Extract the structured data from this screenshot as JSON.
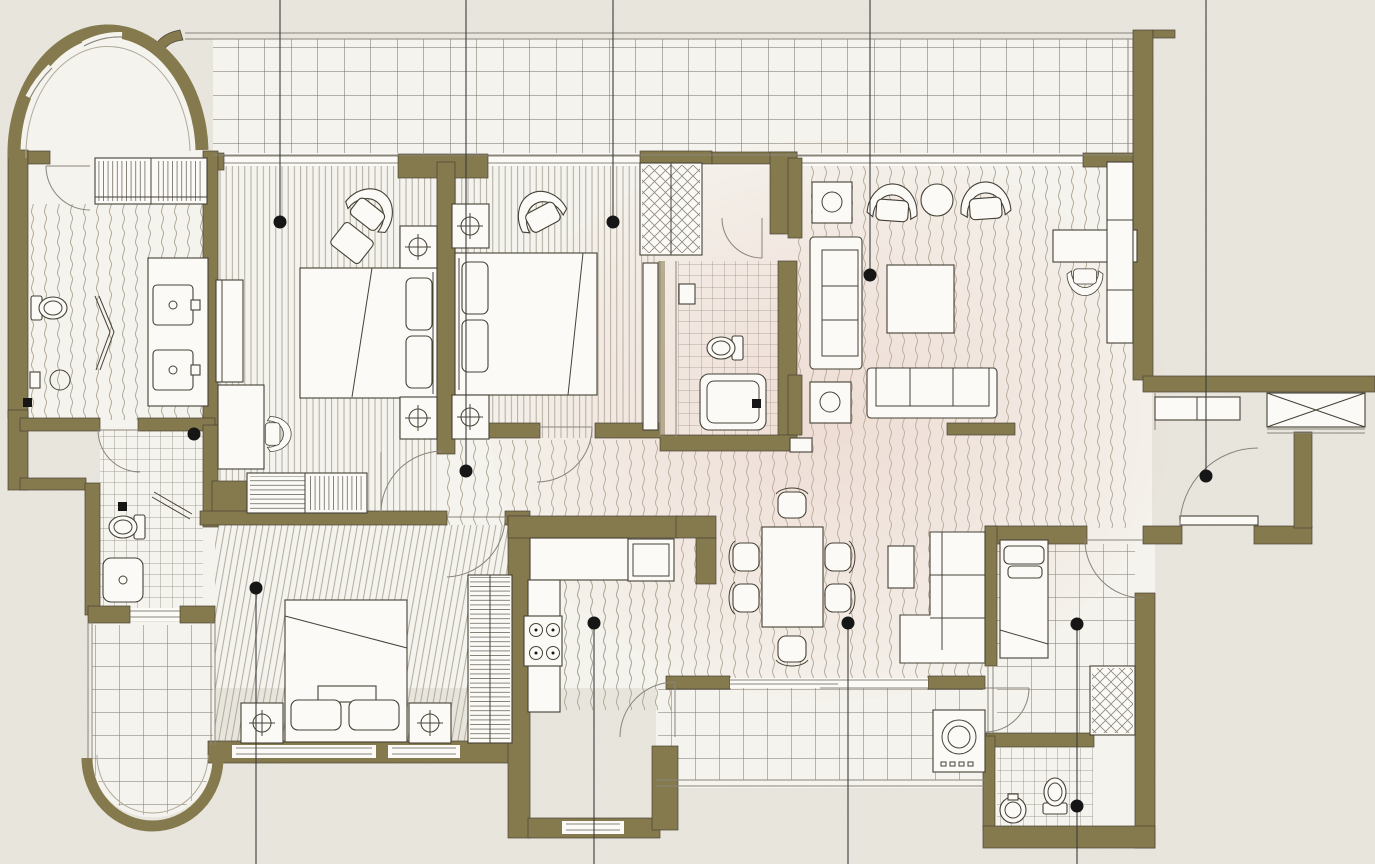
{
  "meta": {
    "title": "Apartment floor plan — 3 bedroom unit with maid room, balconies and living/dining area",
    "drawing_type": "architectural-floor-plan",
    "visible_text": []
  },
  "palette": {
    "background": "#e9e6de",
    "wall": "#857a4e",
    "wall_edge": "#4a4336",
    "line": "#8a857b",
    "line_light": "#b1aa9b",
    "floor": "#f5f3ed",
    "tile": "#716c61",
    "accent_tint": "#e3bcb0",
    "furniture_fill": "#fbfaf6",
    "furniture_stroke": "#454135",
    "marker": "#161616"
  },
  "rooms": [
    {
      "id": "curved-balcony-top-left",
      "floor": "plain",
      "features": [
        "curved window wall"
      ]
    },
    {
      "id": "top-balcony",
      "floor": "tile-grid-large",
      "features": [
        "full-width terrace"
      ]
    },
    {
      "id": "foyer-dressing",
      "floor": "wave-hatch",
      "features": [
        "slatted closet",
        "double sink vanity"
      ]
    },
    {
      "id": "master-bath",
      "floor": "wave-hatch",
      "features": [
        "toilet",
        "bidet",
        "folding shower screen",
        "floor drain"
      ]
    },
    {
      "id": "bedroom-1",
      "floor": "stripe-hatch",
      "features": [
        "double bed",
        "2 nightstand lamps",
        "armchair",
        "ottoman",
        "desk",
        "dresser",
        "walk-in closet"
      ]
    },
    {
      "id": "bedroom-2",
      "floor": "stripe-hatch",
      "features": [
        "double bed",
        "2 nightstand lamps",
        "armchair",
        "wardrobe",
        "dresser"
      ]
    },
    {
      "id": "bathroom-2",
      "floor": "tile-grid-small",
      "features": [
        "toilet",
        "shower",
        "floor drain"
      ]
    },
    {
      "id": "bathroom-3",
      "floor": "tile-grid-small",
      "features": [
        "toilet",
        "shower",
        "folding screen",
        "floor drain"
      ]
    },
    {
      "id": "living-room",
      "floor": "wave-hatch",
      "features": [
        "2 armchairs",
        "round side table",
        "2 lamp tables",
        "2 sofas",
        "coffee table",
        "TV console",
        "desk with chair",
        "tall cabinet"
      ]
    },
    {
      "id": "family-corner",
      "floor": "wave-hatch",
      "features": [
        "L-shaped sectional",
        "side table"
      ]
    },
    {
      "id": "dining-area",
      "floor": "wave-hatch",
      "features": [
        "table for six"
      ]
    },
    {
      "id": "kitchen",
      "floor": "wave-hatch-partial",
      "features": [
        "L-counter",
        "4-burner stove",
        "refrigerator"
      ]
    },
    {
      "id": "bedroom-3",
      "floor": "stripe-hatch-slanted",
      "features": [
        "double bed",
        "2 nightstand lamps",
        "wardrobe"
      ]
    },
    {
      "id": "bottom-left-balcony",
      "floor": "tile-grid-medium",
      "features": [
        "rounded end wall"
      ]
    },
    {
      "id": "rear-balcony",
      "floor": "tile-grid-medium",
      "features": [
        "washing machine",
        "sliding doors"
      ]
    },
    {
      "id": "maid-room",
      "floor": "tile-grid-medium",
      "features": [
        "single bed",
        "wardrobe"
      ]
    },
    {
      "id": "maid-bath",
      "floor": "tile-grid-small",
      "features": [
        "toilet",
        "round sink"
      ]
    },
    {
      "id": "entry-vestibule",
      "floor": "wave-hatch",
      "features": [
        "entry door",
        "shoe cabinet",
        "x-hatched shaft"
      ]
    }
  ],
  "markers": [
    {
      "id": "bedroom-1",
      "x": 280,
      "y": 222,
      "leader": "up"
    },
    {
      "id": "bedroom-2",
      "x": 613,
      "y": 222,
      "leader": "up"
    },
    {
      "id": "living-room",
      "x": 870,
      "y": 275,
      "leader": "up"
    },
    {
      "id": "hallway",
      "x": 466,
      "y": 471,
      "leader": "up"
    },
    {
      "id": "entry",
      "x": 1206,
      "y": 476,
      "leader": "up"
    },
    {
      "id": "dressing",
      "x": 194,
      "y": 434,
      "leader": "none"
    },
    {
      "id": "bedroom-3",
      "x": 256,
      "y": 588,
      "leader": "down"
    },
    {
      "id": "kitchen",
      "x": 594,
      "y": 623,
      "leader": "down"
    },
    {
      "id": "dining",
      "x": 848,
      "y": 623,
      "leader": "down"
    },
    {
      "id": "maid-room",
      "x": 1077,
      "y": 624,
      "leader": "down"
    },
    {
      "id": "maid-bath",
      "x": 1077,
      "y": 806,
      "leader": "none"
    }
  ]
}
